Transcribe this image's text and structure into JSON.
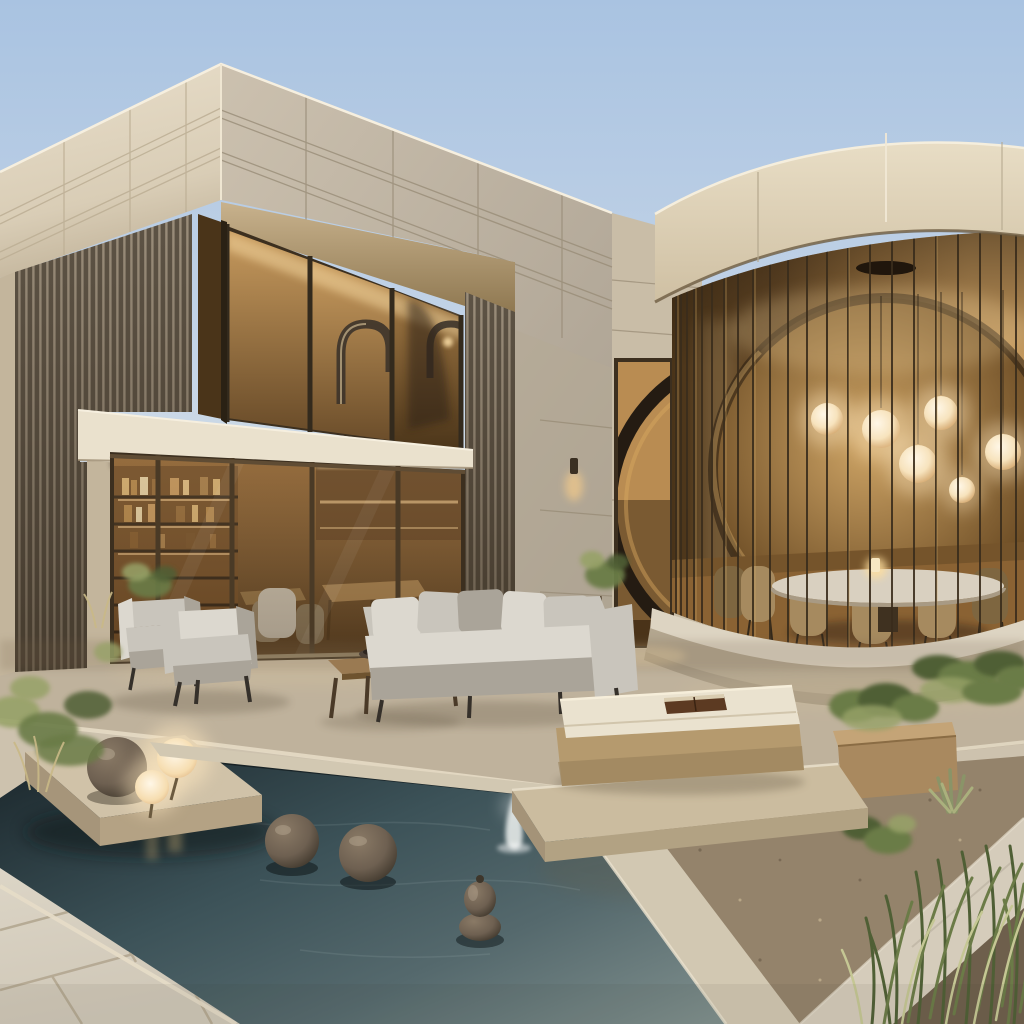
{
  "scene": {
    "type": "photorealistic architectural rendering",
    "setting": "modern desert villa courtyard at dusk with reflecting pool",
    "description": "Two-volume contemporary house: a rectilinear limestone-clad wing with bronze slat screens and amber-lit glazing on the left, joined by a link wall with a tall doorway revealing a giant dark ring artwork, to a round glass pavilion with vertical bronze mullions on the right. In front: a stone terrace with outdoor lounge furniture, a dark reflecting pool with bronze sphere sculptures, a small fountain jet, glowing orb lamps on a stone platform, and desert planting.",
    "sky": {
      "condition": "clear dusk sky",
      "colors": [
        "sky_top",
        "sky_horizon"
      ]
    },
    "buildings": {
      "left_wing": {
        "stories": 2,
        "facade": "cream limestone panels with recessed joint lines",
        "screen": "vertical bronze-wood slat walls",
        "upper_window": {
          "glazing": "amber glass, warm lit interior",
          "gooseneck_sculptures": 2
        },
        "balcony_band": "cream stone slab",
        "ground_glazing": {
          "bookshelf_shelves": 5,
          "dining_tables": 2,
          "interior_chairs": 3,
          "cove_lights": true
        }
      },
      "link_wall": {
        "doorway": "tall warm-lit opening",
        "ring_artwork": "large dark circular ring seen through doorway",
        "wall_sconce": "small down-light, lit"
      },
      "round_pavilion": {
        "crown": "curved cream limestone band",
        "glazing": "floor-to-ceiling curved glass with dense vertical bronze mullions",
        "pendant_globe_lights": 6,
        "ceiling_disc": 1,
        "dining_table": "round stone-top table",
        "dining_chairs": 6,
        "table_candle": 1,
        "base": "curved concrete plinth"
      }
    },
    "pool": {
      "water": "dark teal reflecting pool",
      "fountain_jets": 1,
      "floating_bronze_spheres": 2,
      "gourd_sculpture": 1,
      "stone_platform": {
        "bronze_sphere": 1,
        "glowing_orb_lamps": 2
      }
    },
    "furniture": {
      "outdoor_armchairs": 2,
      "sofa": {
        "seats": 3,
        "pillows": 5,
        "upholstery": "light gray"
      },
      "coffee_table": {
        "material": "wood with metal legs",
        "bowl": 1
      },
      "daybed": {
        "base": "tan upholstery",
        "cushion": "cream",
        "book": 1
      }
    },
    "landscaping": {
      "left_shrubs": "sage desert shrubs and dry grasses",
      "planter_box": "tan rectangular planter with green shrubs",
      "hedge": "low green hedge along pavilion plinth",
      "agave": 1,
      "corner_grasses": "tall green grass blades, bottom right",
      "gravel_beds": 2,
      "concrete_path": "diagonal light concrete walkway"
    },
    "terrace": {
      "upper": "beige concrete terrace at house level",
      "steps": "long stone step edges down to pool level",
      "foreground": "large light stone pavers with grout joints"
    }
  },
  "palette": {
    "sky_top": "#a9c3e1",
    "sky_mid": "#c4d4e7",
    "sky_horizon": "#e2e6e4",
    "stone_cream_light": "#e9dfcb",
    "stone_cream": "#d9cdb6",
    "stone_cream_dark": "#c3b59c",
    "stone_gray_light": "#ccc1af",
    "stone_gray": "#a99f90",
    "soffit_warm": "#c8b28d",
    "soffit_deep": "#8a734c",
    "slat_light": "#9a8d7a",
    "slat_dark": "#5d5345",
    "frame_bronze": "#3c2f1f",
    "glass_amber_light": "#c99c5f",
    "glass_amber": "#a37a45",
    "glass_amber_dark": "#6b4d2a",
    "glass_amber_deep": "#4a3419",
    "interior_glow": "#f6d9a2",
    "wood_interior": "#8a5f30",
    "wood_interior_dark": "#4f371c",
    "drum_band_light": "#e8ddc5",
    "drum_band_dark": "#cfc0a3",
    "backdrop_gold": "#cfa566",
    "backdrop_brown": "#6e4e26",
    "orb_glow": "#ffe8c0",
    "orb_core": "#fff7e7",
    "wall_link": "#c9bda7",
    "wall_side": "#b5aa96",
    "balcony_cream": "#eae1cd",
    "patio": "#bfb29c",
    "patio_light": "#cdc2ae",
    "paver": "#dcd5c6",
    "paver_grout": "#b3a791",
    "step_edge": "#e7ddc8",
    "coping": "#d2c8b2",
    "gravel": "#94836b",
    "gravel_dark": "#6e5f4c",
    "path_concrete": "#d5ccbb",
    "water_dark": "#1f2c31",
    "water_mid": "#3c5258",
    "water_teal": "#55696d",
    "water_light": "#7e8e8c",
    "bronze": "#6e6051",
    "bronze_dark": "#3e362b",
    "plinth_light": "#ddd4c2",
    "plinth_dark": "#b3a68f",
    "cushion_gray": "#c9c5bc",
    "cushion_gray_dark": "#aaa499",
    "cushion_light": "#dcd8cf",
    "cushion_cream": "#eae2cf",
    "daybed_tan": "#b59a6e",
    "daybed_tan_dark": "#97805a",
    "wood_table": "#9a7a52",
    "wood_table_dark": "#6e532f",
    "book_brown": "#5c3a22",
    "green_dark": "#4f5f35",
    "green": "#6b7b47",
    "green_light": "#97a268",
    "green_pale": "#c5c794",
    "trunk": "#4a3a26",
    "chair_tan": "#a68a5f",
    "chair_tan_dark": "#7e6640",
    "candle": "#ffdf9e"
  }
}
